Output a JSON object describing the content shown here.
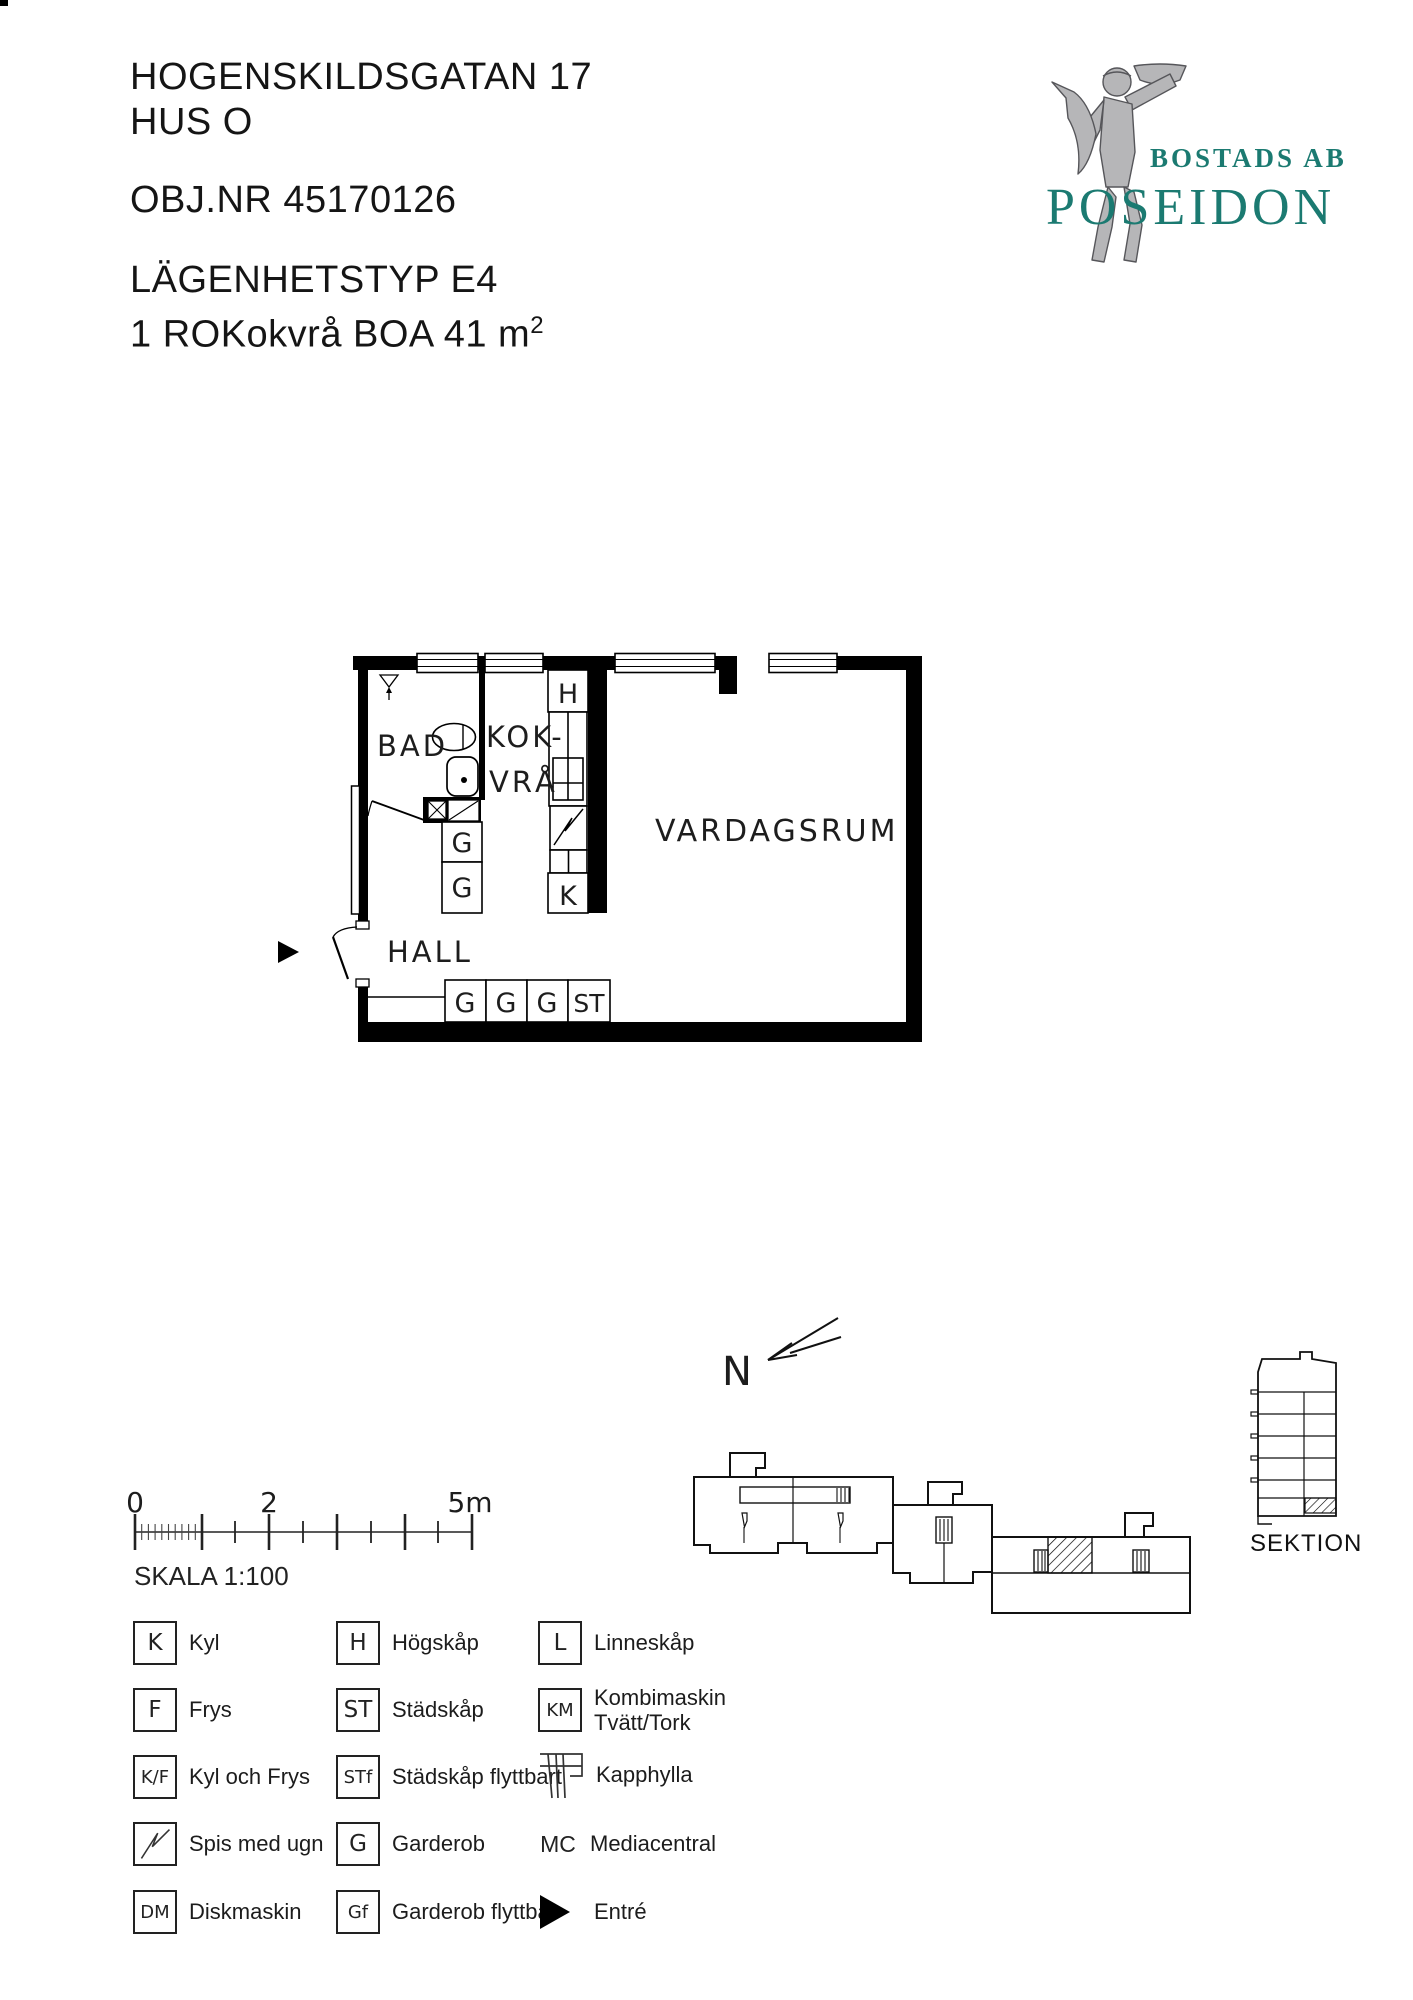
{
  "header": {
    "address_line1": "HOGENSKILDSGATAN 17",
    "address_line2": "HUS O",
    "obj_nr": "OBJ.NR 45170126",
    "type_line": "LÄGENHETSTYP E4",
    "area_line": "1 ROKokvrå BOA 41 m",
    "area_sup": "2"
  },
  "logo": {
    "company_prefix": "BOSTADS AB",
    "company_name": "POSEIDON",
    "accent_color": "#1b7a71",
    "statue_gray": "#b6b6b8"
  },
  "plan": {
    "rooms": {
      "bad": "BAD",
      "kok_line1": "KOK-",
      "kok_line2": "VRÅ",
      "vardagsrum": "VARDAGSRUM",
      "hall": "HALL"
    },
    "cabinets": {
      "h": "H",
      "k": "K",
      "g_mid1": "G",
      "g_mid2": "G",
      "row_g1": "G",
      "row_g2": "G",
      "row_g3": "G",
      "row_st": "ST"
    }
  },
  "scalebar": {
    "tick0": "0",
    "tick2": "2",
    "tick5": "5m",
    "caption": "SKALA 1:100"
  },
  "legend": {
    "items": [
      {
        "sym": "K",
        "label": "Kyl"
      },
      {
        "sym": "H",
        "label": "Högskåp"
      },
      {
        "sym": "L",
        "label": "Linneskåp"
      },
      {
        "sym": "F",
        "label": "Frys"
      },
      {
        "sym": "ST",
        "label": "Städskåp"
      },
      {
        "sym": "KM",
        "label": "Kombimaskin",
        "label2": "Tvätt/Tork"
      },
      {
        "sym": "K/F",
        "label": "Kyl och Frys"
      },
      {
        "sym": "STf",
        "label": "Städskåp flyttbart"
      },
      {
        "sym": "kapphylla-icon",
        "label": "Kapphylla"
      },
      {
        "sym": "spis-icon",
        "label": "Spis med ugn"
      },
      {
        "sym": "G",
        "label": "Garderob"
      },
      {
        "sym": "MC",
        "label": "Mediacentral"
      },
      {
        "sym": "DM",
        "label": "Diskmaskin"
      },
      {
        "sym": "Gf",
        "label": "Garderob flyttbar"
      },
      {
        "sym": "entre-icon",
        "label": "Entré"
      }
    ]
  },
  "compass": {
    "label": "N"
  },
  "section": {
    "label": "SEKTION"
  }
}
